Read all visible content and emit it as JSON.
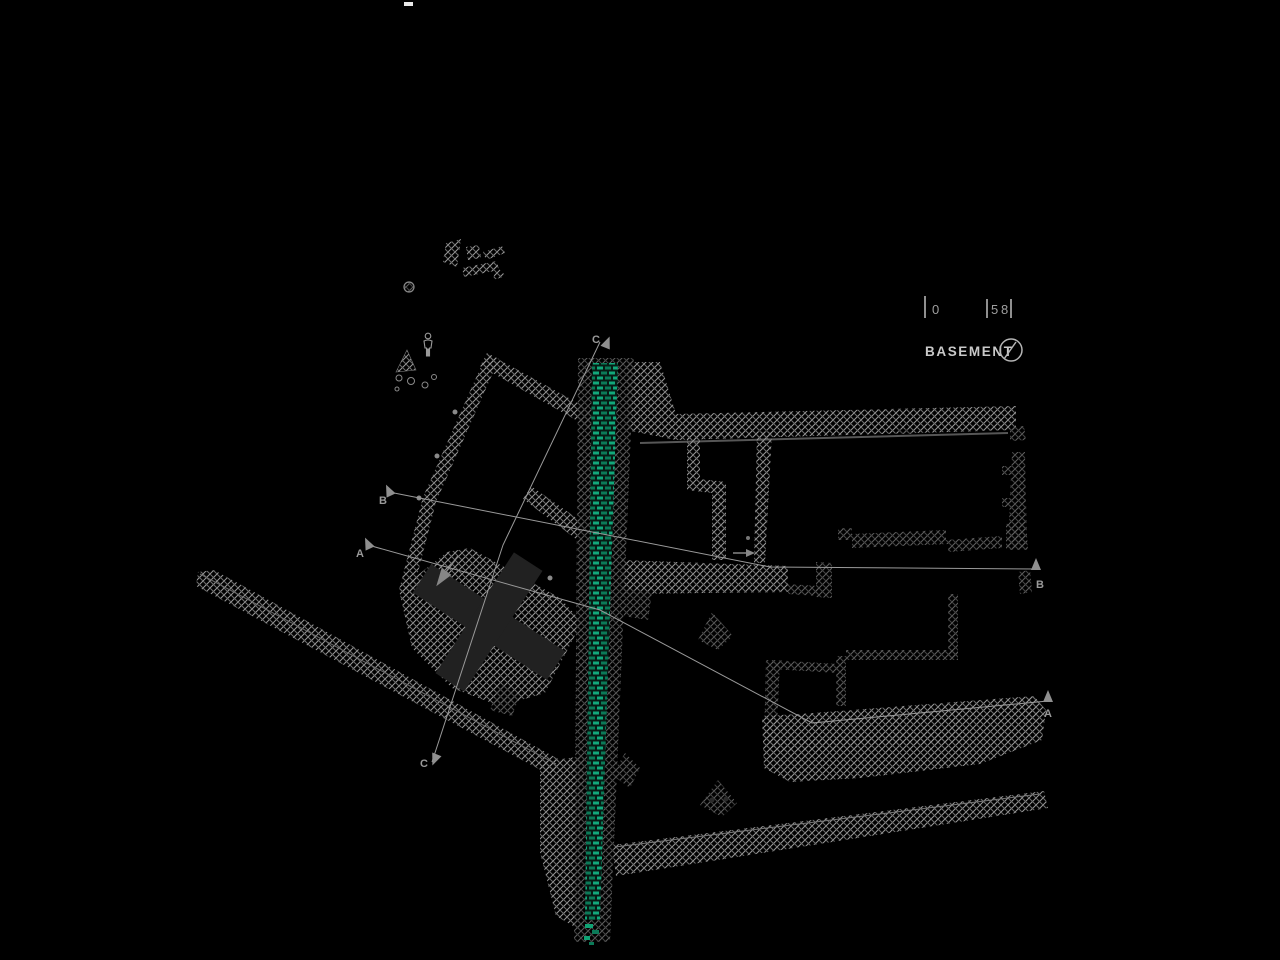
{
  "drawing": {
    "title": "BASEMENT",
    "scale_bar": {
      "tick_0": "0",
      "tick_5": "5",
      "tick_8": "8"
    },
    "section_markers": {
      "a": "A",
      "b": "B",
      "c": "C"
    }
  },
  "colors": {
    "background": "#000000",
    "wall_hatch": "#9a9a9a",
    "wall_hatch_dim": "#606060",
    "green_brick_bright": "#12a87b",
    "green_brick_dark": "#0b7a58",
    "section_line": "#9a9a9a",
    "label_text": "#c9c9c9"
  }
}
